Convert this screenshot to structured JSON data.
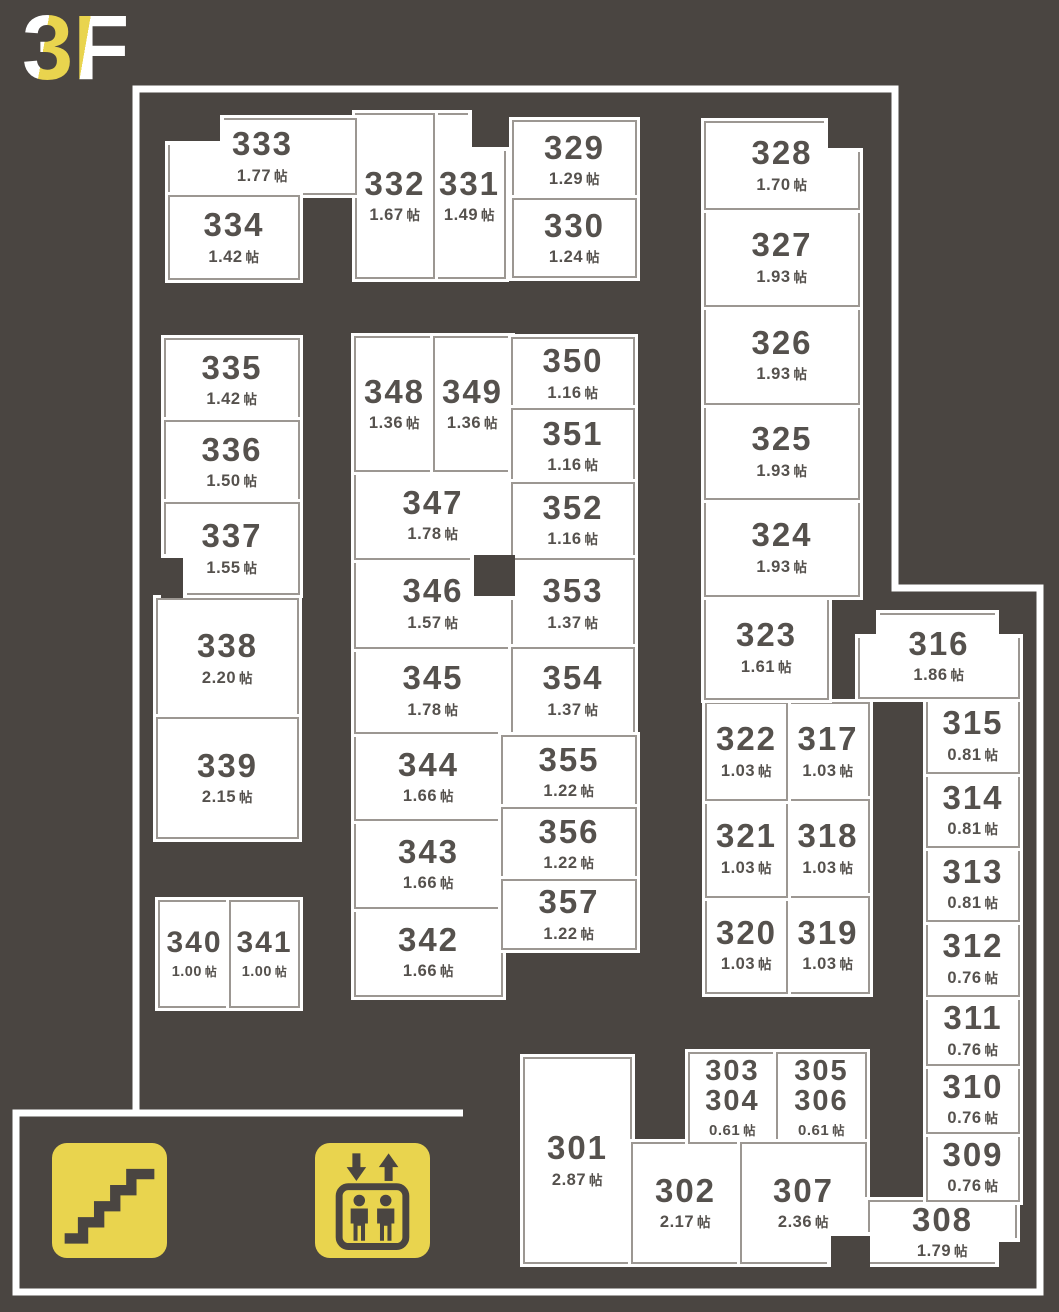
{
  "floor": {
    "label": "3F",
    "chars": [
      "3",
      "F"
    ]
  },
  "size_unit": "帖",
  "colors": {
    "background": "#4a4541",
    "room_fill": "#ffffff",
    "room_border": "#9c9792",
    "room_text": "#55514d",
    "wall": "#ffffff",
    "icon_yellow": "#e9d44e"
  },
  "icons": [
    {
      "name": "stairs"
    },
    {
      "name": "elevator"
    }
  ],
  "rooms": [
    {
      "id": "301",
      "number": "301",
      "size": "2.87"
    },
    {
      "id": "302",
      "number": "302",
      "size": "2.17"
    },
    {
      "id": "303-304",
      "number": "303",
      "number2": "304",
      "size": "0.61"
    },
    {
      "id": "305-306",
      "number": "305",
      "number2": "306",
      "size": "0.61"
    },
    {
      "id": "307",
      "number": "307",
      "size": "2.36"
    },
    {
      "id": "308",
      "number": "308",
      "size": "1.79"
    },
    {
      "id": "309",
      "number": "309",
      "size": "0.76"
    },
    {
      "id": "310",
      "number": "310",
      "size": "0.76"
    },
    {
      "id": "311",
      "number": "311",
      "size": "0.76"
    },
    {
      "id": "312",
      "number": "312",
      "size": "0.76"
    },
    {
      "id": "313",
      "number": "313",
      "size": "0.81"
    },
    {
      "id": "314",
      "number": "314",
      "size": "0.81"
    },
    {
      "id": "315",
      "number": "315",
      "size": "0.81"
    },
    {
      "id": "316",
      "number": "316",
      "size": "1.86"
    },
    {
      "id": "317",
      "number": "317",
      "size": "1.03"
    },
    {
      "id": "318",
      "number": "318",
      "size": "1.03"
    },
    {
      "id": "319",
      "number": "319",
      "size": "1.03"
    },
    {
      "id": "320",
      "number": "320",
      "size": "1.03"
    },
    {
      "id": "321",
      "number": "321",
      "size": "1.03"
    },
    {
      "id": "322",
      "number": "322",
      "size": "1.03"
    },
    {
      "id": "323",
      "number": "323",
      "size": "1.61"
    },
    {
      "id": "324",
      "number": "324",
      "size": "1.93"
    },
    {
      "id": "325",
      "number": "325",
      "size": "1.93"
    },
    {
      "id": "326",
      "number": "326",
      "size": "1.93"
    },
    {
      "id": "327",
      "number": "327",
      "size": "1.93"
    },
    {
      "id": "328",
      "number": "328",
      "size": "1.70"
    },
    {
      "id": "329",
      "number": "329",
      "size": "1.29"
    },
    {
      "id": "330",
      "number": "330",
      "size": "1.24"
    },
    {
      "id": "331",
      "number": "331",
      "size": "1.49"
    },
    {
      "id": "332",
      "number": "332",
      "size": "1.67"
    },
    {
      "id": "333",
      "number": "333",
      "size": "1.77"
    },
    {
      "id": "334",
      "number": "334",
      "size": "1.42"
    },
    {
      "id": "335",
      "number": "335",
      "size": "1.42"
    },
    {
      "id": "336",
      "number": "336",
      "size": "1.50"
    },
    {
      "id": "337",
      "number": "337",
      "size": "1.55"
    },
    {
      "id": "338",
      "number": "338",
      "size": "2.20"
    },
    {
      "id": "339",
      "number": "339",
      "size": "2.15"
    },
    {
      "id": "340",
      "number": "340",
      "size": "1.00"
    },
    {
      "id": "341",
      "number": "341",
      "size": "1.00"
    },
    {
      "id": "342",
      "number": "342",
      "size": "1.66"
    },
    {
      "id": "343",
      "number": "343",
      "size": "1.66"
    },
    {
      "id": "344",
      "number": "344",
      "size": "1.66"
    },
    {
      "id": "345",
      "number": "345",
      "size": "1.78"
    },
    {
      "id": "346",
      "number": "346",
      "size": "1.57"
    },
    {
      "id": "347",
      "number": "347",
      "size": "1.78"
    },
    {
      "id": "348",
      "number": "348",
      "size": "1.36"
    },
    {
      "id": "349",
      "number": "349",
      "size": "1.36"
    },
    {
      "id": "350",
      "number": "350",
      "size": "1.16"
    },
    {
      "id": "351",
      "number": "351",
      "size": "1.16"
    },
    {
      "id": "352",
      "number": "352",
      "size": "1.16"
    },
    {
      "id": "353",
      "number": "353",
      "size": "1.37"
    },
    {
      "id": "354",
      "number": "354",
      "size": "1.37"
    },
    {
      "id": "355",
      "number": "355",
      "size": "1.22"
    },
    {
      "id": "356",
      "number": "356",
      "size": "1.22"
    },
    {
      "id": "357",
      "number": "357",
      "size": "1.22"
    }
  ]
}
